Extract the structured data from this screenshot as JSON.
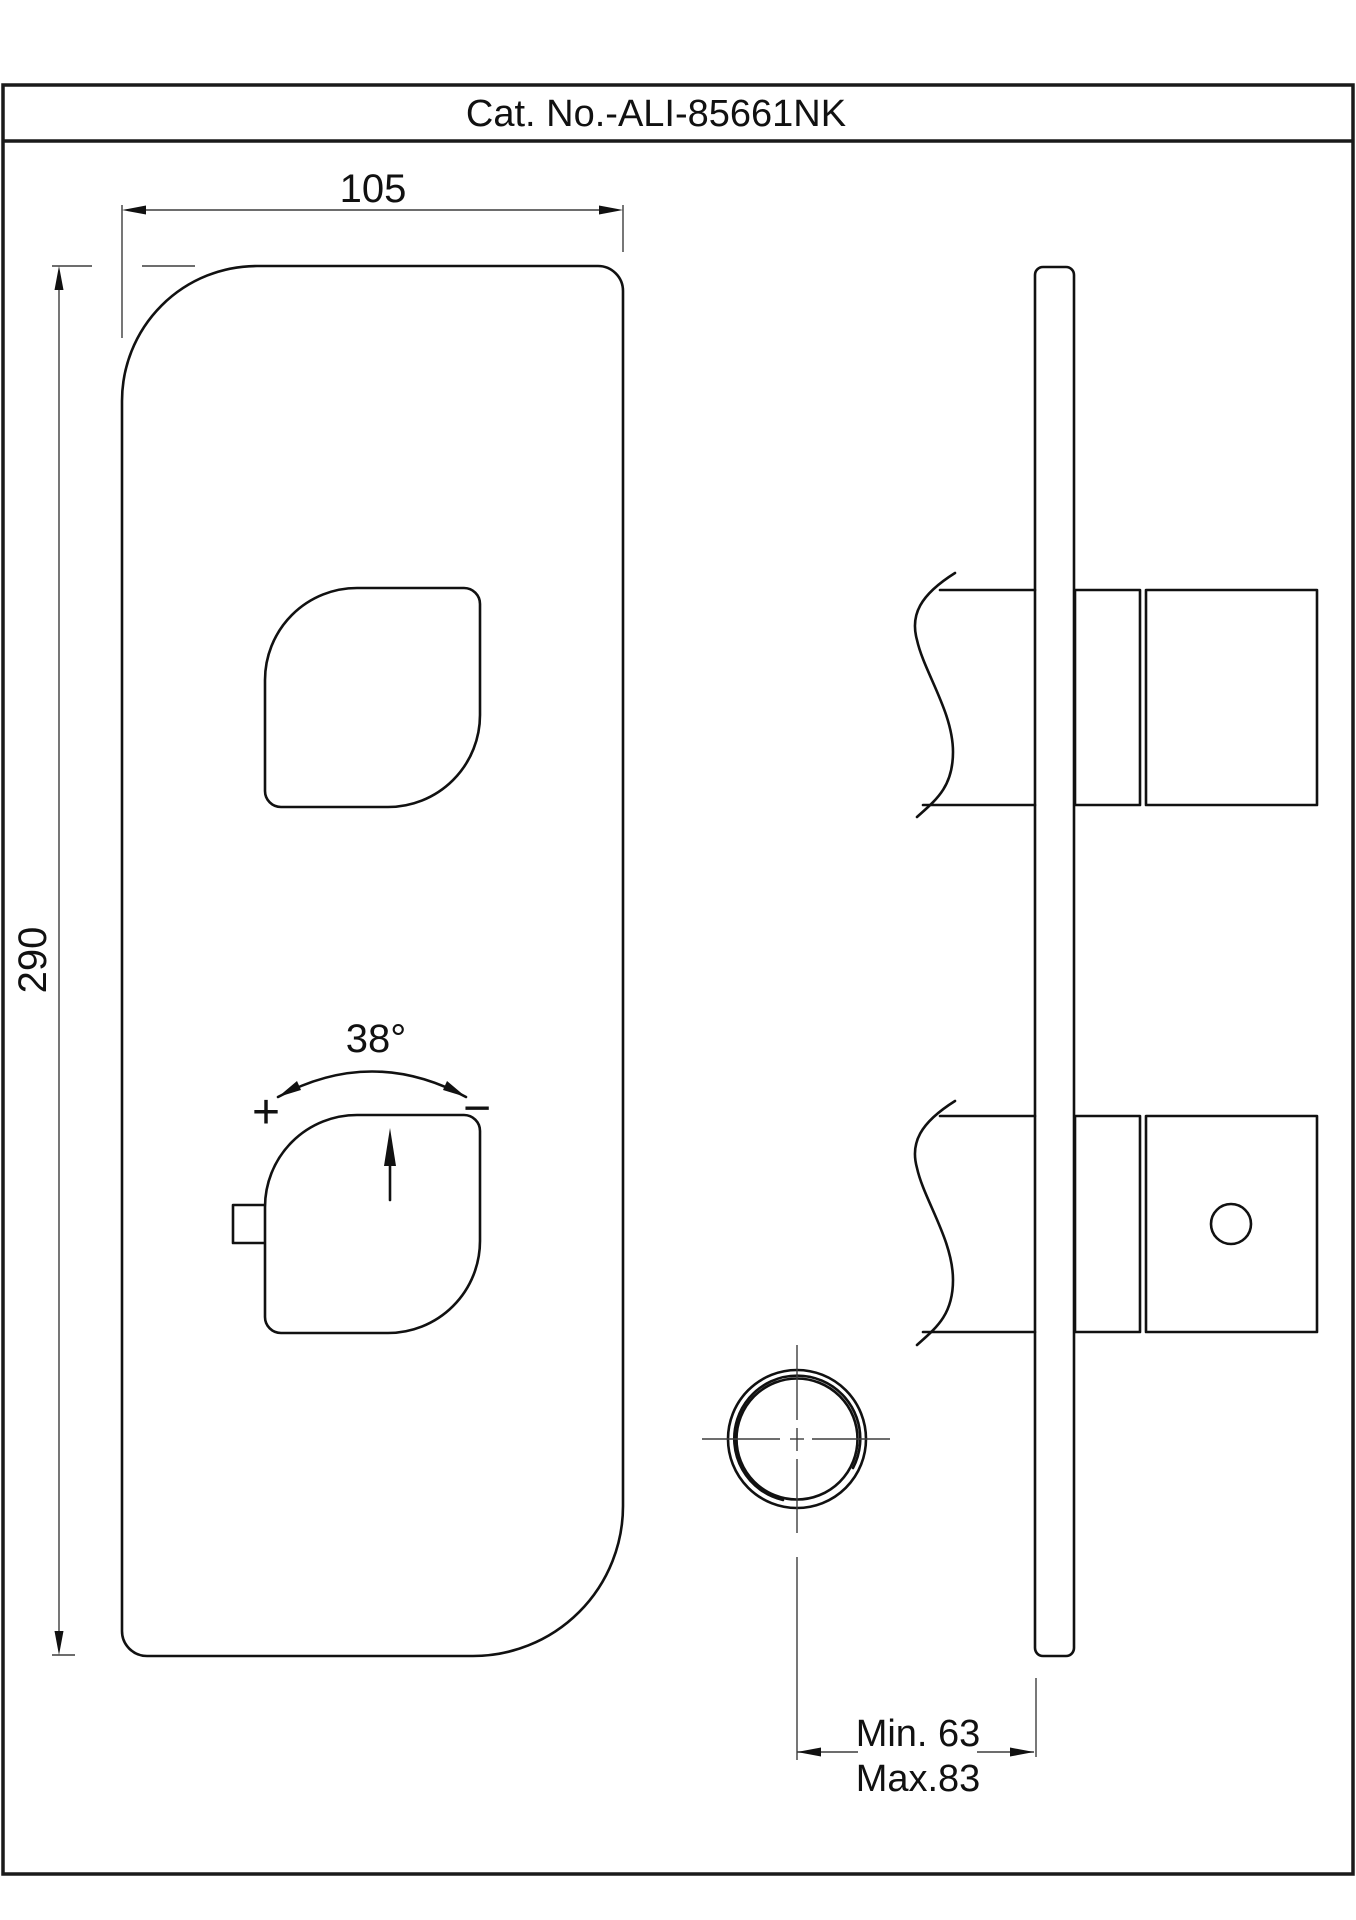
{
  "title_bar": {
    "catalog_number": "Cat. No.-ALI-85661NK"
  },
  "front_view": {
    "width_dim_label": "105",
    "height_dim_label": "290",
    "knob_angle_label": "38°",
    "knob_plus_label": "+",
    "knob_minus_label": "−"
  },
  "side_view": {
    "depth_min_label": "Min. 63",
    "depth_max_label": "Max.83"
  },
  "colors": {
    "object_line": "#111111",
    "dim_line": "#3d3d3d",
    "paper": "#ffffff",
    "frame": "#1a1a1a"
  }
}
